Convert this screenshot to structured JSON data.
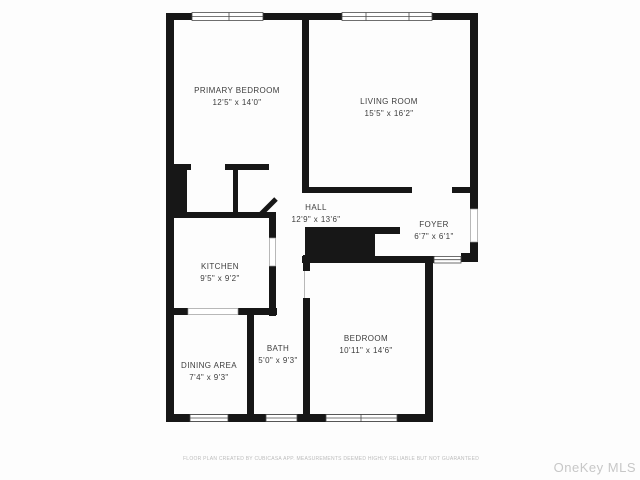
{
  "floorplan": {
    "wall_color": "#171717",
    "rooms": [
      {
        "name": "PRIMARY BEDROOM",
        "dims": "12'5\" x 14'0\"",
        "x": 237,
        "y": 97
      },
      {
        "name": "LIVING ROOM",
        "dims": "15'5\" x 16'2\"",
        "x": 389,
        "y": 108
      },
      {
        "name": "HALL",
        "dims": "12'9\" x 13'6\"",
        "x": 316,
        "y": 214
      },
      {
        "name": "FOYER",
        "dims": "6'7\" x 6'1\"",
        "x": 434,
        "y": 231
      },
      {
        "name": "KITCHEN",
        "dims": "9'5\" x 9'2\"",
        "x": 220,
        "y": 273
      },
      {
        "name": "DINING AREA",
        "dims": "7'4\" x 9'3\"",
        "x": 209,
        "y": 372
      },
      {
        "name": "BATH",
        "dims": "5'0\" x 9'3\"",
        "x": 278,
        "y": 355
      },
      {
        "name": "BEDROOM",
        "dims": "10'11\" x 14'6\"",
        "x": 366,
        "y": 345
      }
    ]
  },
  "footer": {
    "disclaimer": "FLOOR PLAN CREATED BY CUBICASA APP. MEASUREMENTS DEEMED HIGHLY RELIABLE BUT NOT GUARANTEED",
    "watermark": "OneKey MLS"
  }
}
